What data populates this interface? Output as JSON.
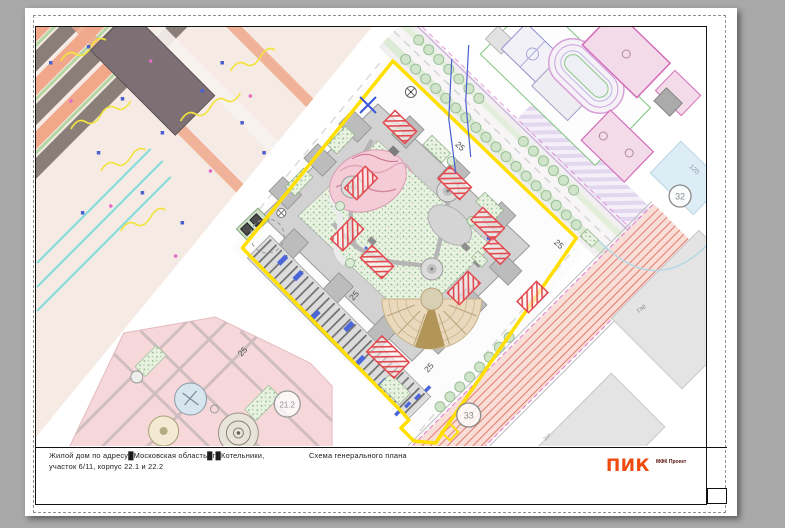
{
  "title_block": {
    "project_line1": "Жилой дом по адресу█Московская область█г█Котельники,",
    "project_line2": "участок 6/11, корпус 22.1 и 22.2",
    "sheet_title": "Схема генерального плана",
    "logo": {
      "text": "ПИК",
      "sub": "МФК Проект",
      "color": "#f04a0e",
      "sub_color": "#551108"
    }
  },
  "map": {
    "site_boundary_color": "#ffdf00",
    "crane_zone_color": "#e14b50",
    "road_labels": [
      {
        "text": "25"
      },
      {
        "text": "25"
      },
      {
        "text": "25"
      },
      {
        "text": "25"
      },
      {
        "text": "25"
      }
    ],
    "parcel_labels": [
      {
        "text": "32"
      },
      {
        "text": "33"
      },
      {
        "text": "21.2"
      }
    ],
    "dim_label": "120",
    "building_labels": [
      {
        "text": "Гар"
      },
      {
        "text": "2эт"
      }
    ]
  }
}
